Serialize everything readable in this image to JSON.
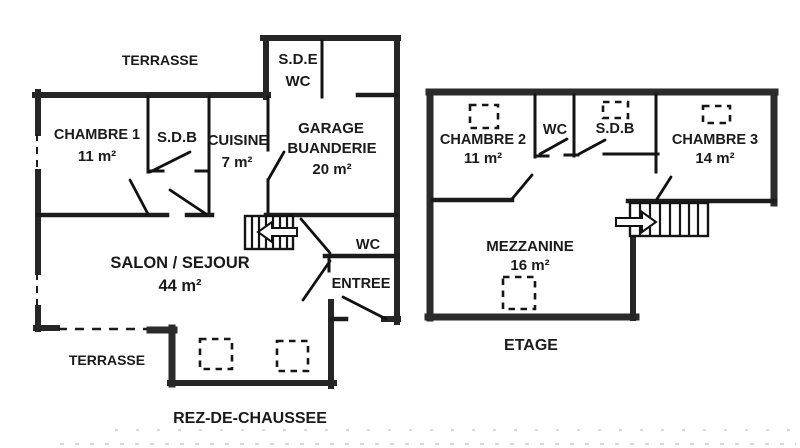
{
  "plan": {
    "colors": {
      "line": "#1c1c1c",
      "outer_wall": "#262626",
      "background": "#ffffff",
      "text": "#1a1a1a"
    },
    "ground_floor": {
      "floor_label": "REZ-DE-CHAUSSEE",
      "terrace_top": "TERRASSE",
      "terrace_bottom": "TERRASSE",
      "chambre1": {
        "name": "CHAMBRE 1",
        "area": "11 m²"
      },
      "sdb": {
        "name": "S.D.B"
      },
      "cuisine": {
        "name": "CUISINE",
        "area": "7 m²"
      },
      "sde_wc": {
        "line1": "S.D.E",
        "line2": "WC"
      },
      "garage": {
        "line1": "GARAGE",
        "line2": "BUANDERIE",
        "area": "20 m²"
      },
      "salon": {
        "name": "SALON / SEJOUR",
        "area": "44 m²"
      },
      "wc": {
        "name": "WC"
      },
      "entree": {
        "name": "ENTREE"
      }
    },
    "upper_floor": {
      "floor_label": "ETAGE",
      "chambre2": {
        "name": "CHAMBRE 2",
        "area": "11 m²"
      },
      "wc": {
        "name": "WC"
      },
      "sdb": {
        "name": "S.D.B"
      },
      "chambre3": {
        "name": "CHAMBRE 3",
        "area": "14 m²"
      },
      "mezzanine": {
        "name": "MEZZANINE",
        "area": "16 m²"
      }
    }
  }
}
